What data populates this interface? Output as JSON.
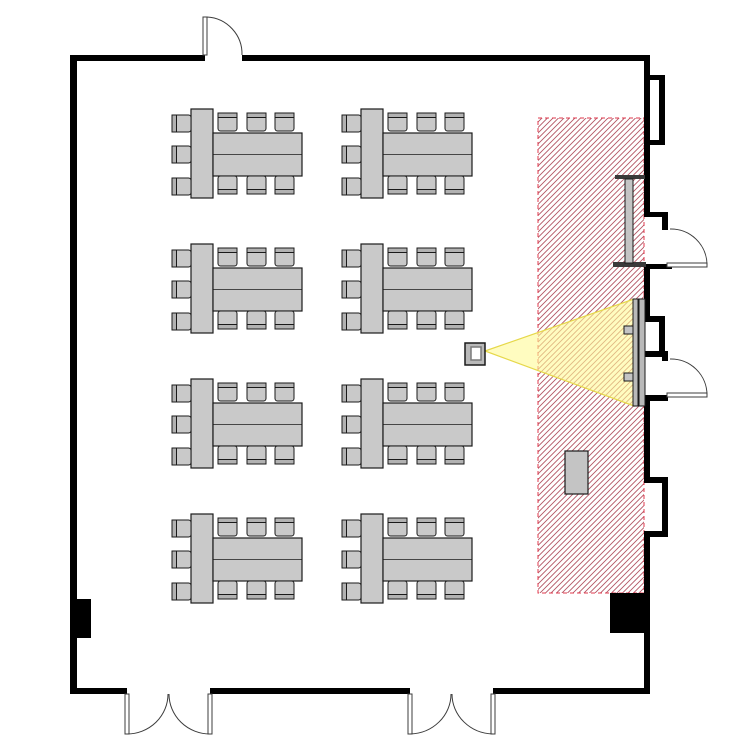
{
  "page": {
    "background": "#ffffff",
    "kind": "classroom-floor-plan"
  },
  "colors": {
    "wall": "#000000",
    "outline": "#1a1a1a",
    "table_fill": "#c9c9c9",
    "chair_fill": "#c9c9c9",
    "chair_back": "#b2b2b2",
    "hatch_line": "#b25563",
    "hatch_border": "#e03a4e",
    "beam_fill": "rgba(255,250,150,0.6)",
    "beam_edge": "#e6d84a",
    "door_stroke": "#3c3c3c",
    "door_leaf_fill": "#ffffff",
    "fixture_fill": "#c4c4c4",
    "whiteboard_cap": "#3a3a3a",
    "screen_fill": "#b9b9b9",
    "projector_fill": "#b9b9b9",
    "projector_lens": "#ffffff"
  },
  "floor_plan": {
    "room": {
      "x": 70,
      "y": 55,
      "width": 580,
      "height": 639,
      "wall_thickness": 6
    },
    "walls": [
      [
        70,
        55,
        135,
        6
      ],
      [
        242,
        55,
        408,
        6
      ],
      [
        70,
        55,
        7,
        639
      ],
      [
        70,
        688,
        57,
        6
      ],
      [
        210,
        688,
        200,
        6
      ],
      [
        493,
        688,
        157,
        6
      ],
      [
        644,
        55,
        6,
        162
      ],
      [
        644,
        75,
        21,
        5
      ],
      [
        659,
        80,
        6,
        60
      ],
      [
        644,
        140,
        21,
        5
      ],
      [
        644,
        212,
        24,
        5
      ],
      [
        662,
        217,
        6,
        13
      ],
      [
        644,
        264,
        28,
        5
      ],
      [
        644,
        264,
        6,
        54
      ],
      [
        644,
        316,
        21,
        6
      ],
      [
        659,
        322,
        6,
        31
      ],
      [
        644,
        351,
        24,
        6
      ],
      [
        662,
        351,
        6,
        10
      ],
      [
        644,
        395,
        24,
        6
      ],
      [
        644,
        395,
        6,
        82
      ],
      [
        644,
        477,
        24,
        6
      ],
      [
        662,
        483,
        6,
        48
      ],
      [
        644,
        531,
        24,
        6
      ],
      [
        644,
        531,
        6,
        163
      ]
    ],
    "columns": [
      [
        70,
        599,
        21,
        39
      ],
      [
        610,
        593,
        38,
        40
      ]
    ],
    "doors": [
      {
        "id": "top-entry-door",
        "leaves": [
          [
            203,
            17,
            4,
            38
          ]
        ],
        "arcs": [
          "M 207,17 A 37,37 0 0 1 242,55"
        ]
      },
      {
        "id": "right-upper-door",
        "leaves": [
          [
            667,
            263,
            40,
            4
          ]
        ],
        "arcs": [
          "M 707,265 A 36,36 0 0 0 670,229"
        ]
      },
      {
        "id": "right-lower-door",
        "leaves": [
          [
            667,
            393,
            40,
            4
          ]
        ],
        "arcs": [
          "M 707,395 A 36,36 0 0 0 670,359"
        ]
      },
      {
        "id": "bottom-left-double-door",
        "leaves": [
          [
            125,
            694,
            4,
            40
          ],
          [
            208,
            694,
            4,
            40
          ]
        ],
        "arcs": [
          "M 168,694 A 41,40 0 0 1 127,734",
          "M 169,694 A 41,40 0 0 0 210,734"
        ]
      },
      {
        "id": "bottom-right-double-door",
        "leaves": [
          [
            408,
            694,
            4,
            40
          ],
          [
            491,
            694,
            4,
            40
          ]
        ],
        "arcs": [
          "M 451,694 A 42,40 0 0 1 410,734",
          "M 452,694 A 42,40 0 0 0 493,734"
        ]
      }
    ],
    "tables": {
      "count": 8,
      "seats_per_table": 9,
      "origins": [
        [
          172,
          109
        ],
        [
          342,
          109
        ],
        [
          172,
          244
        ],
        [
          342,
          244
        ],
        [
          172,
          379
        ],
        [
          342,
          379
        ],
        [
          172,
          514
        ],
        [
          342,
          514
        ]
      ],
      "head_table": [
        19,
        0,
        22,
        89
      ],
      "long_table": [
        41,
        24,
        89,
        43
      ],
      "divider_y": 45.5,
      "left_chairs": {
        "x": 0,
        "ys": [
          6,
          37,
          69
        ],
        "w": 19,
        "h": 17,
        "facing": "right"
      },
      "top_chairs": {
        "y": 4,
        "xs": [
          46,
          75,
          103
        ],
        "w": 19,
        "h": 18,
        "facing": "down"
      },
      "bottom_chairs": {
        "y": 67,
        "xs": [
          46,
          75,
          103
        ],
        "w": 19,
        "h": 18,
        "facing": "up"
      }
    },
    "projection_zone": {
      "rect": [
        538,
        118,
        106,
        475
      ],
      "hatch_spacing": 5.5,
      "border_dash": "4 3"
    },
    "beam": {
      "points": "485,351 634,299 634,406"
    },
    "projector": {
      "body": [
        465,
        343,
        20,
        22
      ],
      "lens": [
        471,
        347,
        10,
        13
      ]
    },
    "whiteboard": {
      "caps": [
        [
          615,
          175,
          30,
          4
        ],
        [
          613,
          262,
          33,
          5
        ]
      ],
      "stem": [
        625,
        179,
        8,
        84
      ]
    },
    "screen": {
      "panels": [
        [
          633,
          299,
          5,
          107
        ],
        [
          639,
          299,
          6,
          107
        ]
      ],
      "brackets": [
        [
          624,
          326,
          9,
          8
        ],
        [
          624,
          373,
          9,
          8
        ]
      ]
    },
    "podium": {
      "rect": [
        565,
        451,
        23,
        43
      ]
    }
  }
}
